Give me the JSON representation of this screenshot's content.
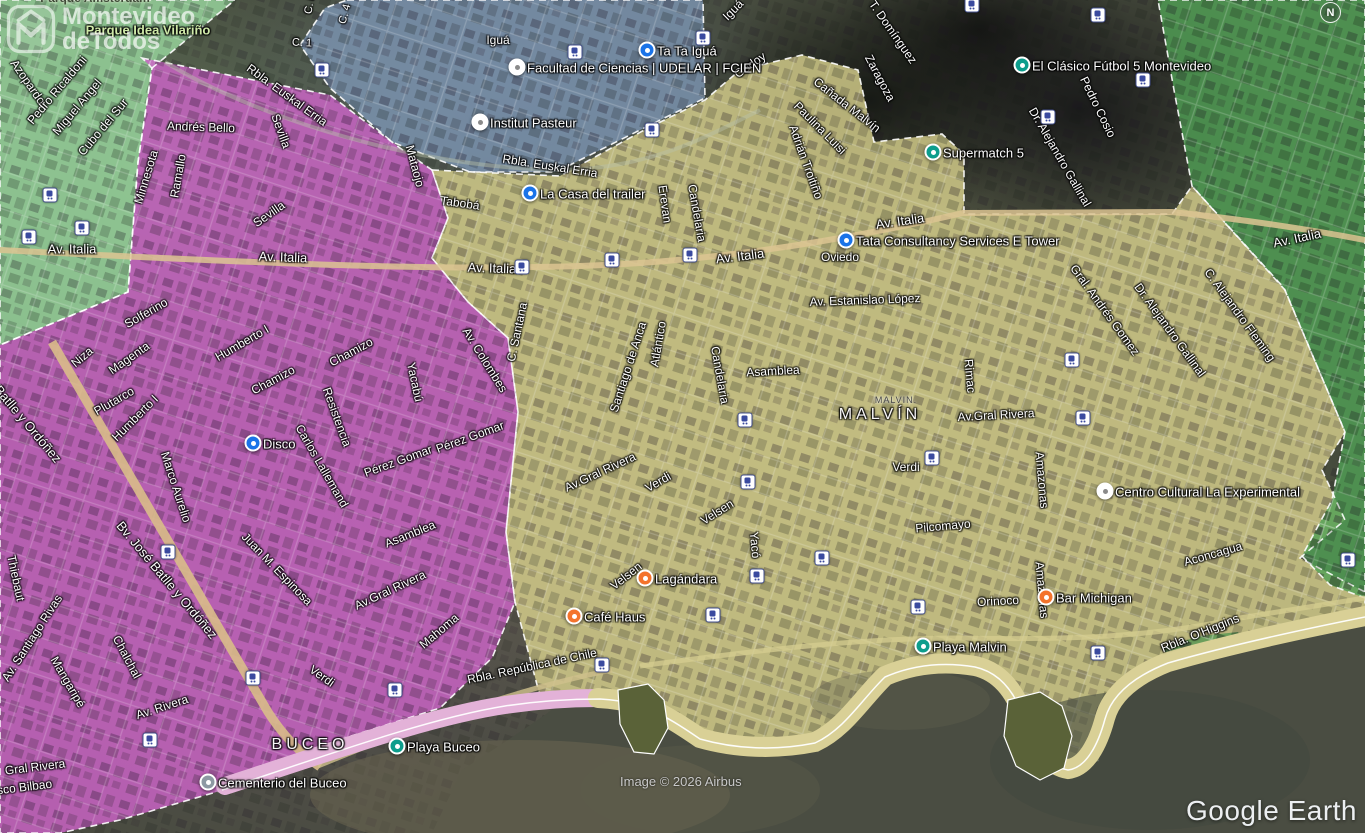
{
  "branding": {
    "logo_line1": "Montevideo",
    "logo_line2": "deTodos",
    "compass": "N",
    "attribution": "Image © 2026 Airbus",
    "google_earth": "Google Earth"
  },
  "map": {
    "zones": [
      {
        "name": "zone-green-nw",
        "fill": "rgba(150,210,155,0.85)",
        "points": "0,0 235,0 152,68 138,162 128,292 0,345",
        "dashed": true
      },
      {
        "name": "zone-blue-malvin-norte",
        "fill": "rgba(125,150,180,0.8)",
        "points": "347,0 703,0 705,98 640,130 556,172 470,172 392,142 330,88 300,45 325,8",
        "dashed": true
      },
      {
        "name": "zone-pink-buceo",
        "fill": "rgba(205,100,200,0.82)",
        "points": "142,58 330,95 400,148 432,170 448,218 432,258 468,302 508,338 518,412 506,532 515,602 492,658 440,708 345,738 230,788 120,820 60,833 0,833 0,345 128,292 138,162 152,68",
        "dashed": true
      },
      {
        "name": "zone-yellow-malvin",
        "fill": "rgba(215,207,140,0.82)",
        "points": "432,170 560,176 648,128 705,100 740,70 802,55 858,70 874,142 942,134 964,154 964,214 1172,214 1192,186 1285,290 1345,432 1322,470 1345,520 1300,558 1365,592 1365,622 1240,643 1165,663 1128,688 1110,718 1100,760 1080,770 1056,768 1036,745 1020,713 1005,688 972,667 935,663 898,668 862,690 820,742 778,748 740,744 700,738 660,712 640,700 598,698 560,702 540,696 515,602 506,532 518,412 508,338 468,302 432,258 448,218",
        "dashed": true
      },
      {
        "name": "zone-green-east",
        "fill": "rgba(80,160,85,0.8)",
        "points": "1158,0 1365,0 1365,598 1330,585 1302,556 1332,500 1345,432 1284,288 1192,186 1174,90",
        "dashed": true
      },
      {
        "name": "zone-green-headland",
        "fill": "rgba(80,150,80,0.75)",
        "points": "1162,648 1200,636 1238,632 1248,650 1220,668 1180,672",
        "dashed": false
      }
    ],
    "roads": [
      {
        "d": "M0,250 C250,263 480,274 640,263 C770,254 890,230 963,213 L1172,212 C1250,220 1312,230 1365,240",
        "color": "#dcc492",
        "w": 6,
        "o": 0.85
      },
      {
        "d": "M52,342 L268,712 C282,734 300,753 320,767",
        "color": "#d9bd8a",
        "w": 9,
        "o": 0.9
      },
      {
        "d": "M318,766 C420,724 520,688 612,670",
        "color": "#cfc08c",
        "w": 5,
        "o": 0.8
      },
      {
        "d": "M640,666 C760,650 860,638 960,638 C1060,640 1150,638 1240,618 L1365,598",
        "color": "#d5cd90",
        "w": 5,
        "o": 0.75
      },
      {
        "d": "M165,62 C260,120 420,168 560,170 C650,168 700,140 760,110",
        "color": "#b8c0a8",
        "w": 4,
        "o": 0.45
      }
    ],
    "water": {
      "fill": "#4a4d42",
      "points": "432,833 462,770 505,742 545,715 560,703 598,700 640,702 660,714 700,740 742,746 780,748 820,742 862,690 898,670 935,665 975,668 1005,690 1020,715 1040,748 1058,770 1080,772 1098,762 1110,720 1128,690 1165,665 1240,645 1365,624 1365,833",
      "tints": [
        {
          "x": 520,
          "y": 795,
          "rx": 210,
          "ry": 55,
          "fill": "#6e6751",
          "o": 0.5
        },
        {
          "x": 700,
          "y": 790,
          "rx": 120,
          "ry": 45,
          "fill": "#5d5c4b",
          "o": 0.4
        },
        {
          "x": 1150,
          "y": 760,
          "rx": 160,
          "ry": 70,
          "fill": "#434a40",
          "o": 0.6
        },
        {
          "x": 900,
          "y": 700,
          "rx": 90,
          "ry": 30,
          "fill": "#60604e",
          "o": 0.35
        }
      ]
    },
    "coast": {
      "sands": [
        {
          "d": "M225,786 C330,752 430,716 505,705 C545,699 575,698 598,698",
          "color": "#e3b2d8",
          "w": 18
        },
        {
          "d": "M598,698 C640,700 662,712 700,738 C735,748 775,750 815,742 C845,728 862,698 885,676 C915,663 945,661 975,666 C1002,672 1016,694 1024,718 C1035,748 1050,766 1068,769 C1086,767 1098,744 1105,718 C1112,693 1135,675 1168,662 C1230,644 1300,629 1365,616",
          "color": "#d9d096",
          "w": 20
        }
      ],
      "waterline": "M222,790 C330,754 430,718 505,706 C545,700 575,699 600,699 C640,701 662,713 700,739 C735,749 775,751 815,743 C845,729 862,699 885,677 C915,664 945,662 975,667 C1002,673 1016,695 1024,719 C1035,749 1050,767 1068,770 C1086,768 1098,745 1105,719 C1112,694 1135,676 1168,663 C1230,645 1300,630 1365,617",
      "headlands": [
        "618,690 648,684 664,700 668,728 654,754 634,752 620,724",
        "1008,700 1040,692 1062,706 1072,736 1064,768 1040,780 1016,766 1004,736"
      ]
    },
    "street_labels": [
      {
        "t": "Parque Idea Vilariño",
        "x": 148,
        "y": 30,
        "r": 0,
        "s": 13,
        "cls": "park"
      },
      {
        "t": "Parque Amsterdam",
        "x": 95,
        "y": -2,
        "r": 0,
        "s": 12,
        "cls": "parkdark"
      },
      {
        "t": "Azopardo",
        "x": 28,
        "y": 82,
        "r": 55
      },
      {
        "t": "Pedro Ricaldoni",
        "x": 57,
        "y": 90,
        "r": -50
      },
      {
        "t": "Miguel Angel",
        "x": 77,
        "y": 107,
        "r": -50
      },
      {
        "t": "Cubo del Sur",
        "x": 103,
        "y": 127,
        "r": -50
      },
      {
        "t": "Minnesota",
        "x": 146,
        "y": 177,
        "r": -73
      },
      {
        "t": "Ramallo",
        "x": 178,
        "y": 176,
        "r": -80
      },
      {
        "t": "Andrés Bello",
        "x": 201,
        "y": 127,
        "r": 2
      },
      {
        "t": "Sevilla",
        "x": 281,
        "y": 131,
        "r": 70
      },
      {
        "t": "Sevilla",
        "x": 269,
        "y": 214,
        "r": -35
      },
      {
        "t": "Mataojo",
        "x": 415,
        "y": 166,
        "r": 75
      },
      {
        "t": "C. 8",
        "x": 310,
        "y": 4,
        "r": -80,
        "s": 11
      },
      {
        "t": "C. 4",
        "x": 345,
        "y": 14,
        "r": -75,
        "s": 11
      },
      {
        "t": "C. 1",
        "x": 302,
        "y": 43,
        "r": 3,
        "s": 11
      },
      {
        "t": "Rbla. Euskal Erria",
        "x": 287,
        "y": 95,
        "r": 36
      },
      {
        "t": "Rbla. Euskal Erria",
        "x": 550,
        "y": 166,
        "r": 9
      },
      {
        "t": "Iguá",
        "x": 498,
        "y": 40,
        "r": 0
      },
      {
        "t": "Iguá",
        "x": 733,
        "y": 10,
        "r": -45
      },
      {
        "t": "Godoy",
        "x": 750,
        "y": 65,
        "r": -35
      },
      {
        "t": "Zaragoza",
        "x": 880,
        "y": 78,
        "r": 62
      },
      {
        "t": "T. Domínguez",
        "x": 893,
        "y": 32,
        "r": 55
      },
      {
        "t": "Pedro Cosio",
        "x": 1098,
        "y": 107,
        "r": 64
      },
      {
        "t": "Dr. Alejandro Gallinal",
        "x": 1060,
        "y": 157,
        "r": 60
      },
      {
        "t": "Cañada Malvín",
        "x": 847,
        "y": 105,
        "r": 38
      },
      {
        "t": "Paulina Luisi",
        "x": 820,
        "y": 128,
        "r": 45
      },
      {
        "t": "Adrián Troitiño",
        "x": 806,
        "y": 162,
        "r": 70
      },
      {
        "t": "Av. Italia",
        "x": 72,
        "y": 249,
        "r": 0,
        "s": 13
      },
      {
        "t": "Av. Italia",
        "x": 283,
        "y": 257,
        "r": 2,
        "s": 13
      },
      {
        "t": "Av. Italia",
        "x": 492,
        "y": 268,
        "r": 2,
        "s": 13
      },
      {
        "t": "Av. Italia",
        "x": 740,
        "y": 256,
        "r": -7,
        "s": 13
      },
      {
        "t": "Av. Italia",
        "x": 900,
        "y": 221,
        "r": -8,
        "s": 13
      },
      {
        "t": "Av. Italia",
        "x": 1297,
        "y": 238,
        "r": -12,
        "s": 13
      },
      {
        "t": "Tabobá",
        "x": 460,
        "y": 203,
        "r": 8
      },
      {
        "t": "Solferino",
        "x": 146,
        "y": 313,
        "r": -30
      },
      {
        "t": "Niza",
        "x": 82,
        "y": 357,
        "r": -40
      },
      {
        "t": "Magenta",
        "x": 129,
        "y": 358,
        "r": -35
      },
      {
        "t": "Plutarco",
        "x": 114,
        "y": 401,
        "r": -30
      },
      {
        "t": "Humberto I",
        "x": 242,
        "y": 343,
        "r": -30
      },
      {
        "t": "Humberto I",
        "x": 135,
        "y": 418,
        "r": -45
      },
      {
        "t": "Chamizo",
        "x": 273,
        "y": 380,
        "r": -28
      },
      {
        "t": "Chamizo",
        "x": 351,
        "y": 352,
        "r": -28
      },
      {
        "t": "Resistencia",
        "x": 337,
        "y": 417,
        "r": 70
      },
      {
        "t": "Yacabú",
        "x": 415,
        "y": 382,
        "r": 78
      },
      {
        "t": "Carlos Lallemand",
        "x": 322,
        "y": 466,
        "r": 60
      },
      {
        "t": "Pérez Gomar",
        "x": 398,
        "y": 461,
        "r": -20
      },
      {
        "t": "Pérez Gomar",
        "x": 470,
        "y": 437,
        "r": -20
      },
      {
        "t": "Marco Aurelio",
        "x": 176,
        "y": 487,
        "r": 72
      },
      {
        "t": "Batlle y Ordóñez",
        "x": 28,
        "y": 424,
        "r": 50,
        "s": 13
      },
      {
        "t": "Bv. José Batlle y Ordóñez",
        "x": 167,
        "y": 580,
        "r": 50,
        "s": 13
      },
      {
        "t": "Juan M. Espinosa",
        "x": 277,
        "y": 569,
        "r": 46
      },
      {
        "t": "Asamblea",
        "x": 410,
        "y": 534,
        "r": -22
      },
      {
        "t": "Av.Gral Rivera",
        "x": 390,
        "y": 590,
        "r": -25
      },
      {
        "t": "Mahoma",
        "x": 439,
        "y": 631,
        "r": -40
      },
      {
        "t": "Thiebaut",
        "x": 16,
        "y": 578,
        "r": 78
      },
      {
        "t": "Av. Santiago Rivas",
        "x": 32,
        "y": 638,
        "r": -57
      },
      {
        "t": "Mangaripé",
        "x": 68,
        "y": 682,
        "r": 60
      },
      {
        "t": "Chalchal",
        "x": 127,
        "y": 657,
        "r": 62
      },
      {
        "t": "Av. Rivera",
        "x": 162,
        "y": 707,
        "r": -18
      },
      {
        "t": "Gral Rivera",
        "x": 35,
        "y": 767,
        "r": -7
      },
      {
        "t": "Francisco Bilbao",
        "x": 8,
        "y": 789,
        "r": -7
      },
      {
        "t": "Verdi",
        "x": 322,
        "y": 676,
        "r": 35
      },
      {
        "t": "Erevan",
        "x": 665,
        "y": 204,
        "r": 82
      },
      {
        "t": "Candelaria",
        "x": 697,
        "y": 213,
        "r": 80
      },
      {
        "t": "Candelaria",
        "x": 720,
        "y": 375,
        "r": 80
      },
      {
        "t": "C. Santana",
        "x": 517,
        "y": 332,
        "r": -78
      },
      {
        "t": "Av. Colombes",
        "x": 485,
        "y": 360,
        "r": 58
      },
      {
        "t": "Santiago de Anca",
        "x": 628,
        "y": 367,
        "r": -72
      },
      {
        "t": "Atlántico",
        "x": 658,
        "y": 344,
        "r": -80
      },
      {
        "t": "Asamblea",
        "x": 773,
        "y": 371,
        "r": -3
      },
      {
        "t": "Av. Estanislao López",
        "x": 865,
        "y": 300,
        "r": -2
      },
      {
        "t": "Oviedo",
        "x": 840,
        "y": 257,
        "r": 0
      },
      {
        "t": "Rimac",
        "x": 970,
        "y": 376,
        "r": 85
      },
      {
        "t": "Gral. Andrés Gomez",
        "x": 1105,
        "y": 310,
        "r": 54
      },
      {
        "t": "Dr. Alejandro Gallinal",
        "x": 1170,
        "y": 330,
        "r": 54
      },
      {
        "t": "C. Alejandro Fleming",
        "x": 1240,
        "y": 315,
        "r": 54
      },
      {
        "t": "Av.Gral Rivera",
        "x": 996,
        "y": 415,
        "r": -3
      },
      {
        "t": "Av.Gral Rivera",
        "x": 600,
        "y": 472,
        "r": -25
      },
      {
        "t": "Verdi",
        "x": 658,
        "y": 482,
        "r": -30
      },
      {
        "t": "Verdi",
        "x": 906,
        "y": 467,
        "r": 0
      },
      {
        "t": "Velsen",
        "x": 717,
        "y": 512,
        "r": -32
      },
      {
        "t": "Velsen",
        "x": 626,
        "y": 576,
        "r": -38
      },
      {
        "t": "Yacó",
        "x": 755,
        "y": 545,
        "r": 85
      },
      {
        "t": "Pilcomayo",
        "x": 943,
        "y": 526,
        "r": -5
      },
      {
        "t": "Amazonas",
        "x": 1042,
        "y": 480,
        "r": 85
      },
      {
        "t": "Amazonas",
        "x": 1042,
        "y": 590,
        "r": 85
      },
      {
        "t": "Aconcagua",
        "x": 1213,
        "y": 554,
        "r": -16
      },
      {
        "t": "Orinoco",
        "x": 998,
        "y": 601,
        "r": -3
      },
      {
        "t": "Rbla. República de Chile",
        "x": 532,
        "y": 666,
        "r": -12
      },
      {
        "t": "Rbla. O'Higgins",
        "x": 1200,
        "y": 633,
        "r": -22
      },
      {
        "t": "MALVIN.",
        "x": 896,
        "y": 400,
        "r": 0,
        "s": 9,
        "cls": "areasmall"
      },
      {
        "t": "MALVÍN",
        "x": 880,
        "y": 415,
        "r": 0,
        "s": 16,
        "cls": "area"
      },
      {
        "t": "BUCEO",
        "x": 310,
        "y": 745,
        "r": 0,
        "s": 16,
        "cls": "area"
      }
    ],
    "poi_types": {
      "shop": {
        "bg": "#1a73e8",
        "fg": "#ffffff"
      },
      "leisure": {
        "bg": "#0c9d8c",
        "fg": "#ffffff"
      },
      "food": {
        "bg": "#f4732c",
        "fg": "#ffffff"
      },
      "civic": {
        "bg": "#ffffff",
        "fg": "#8a8a8a"
      },
      "cemetery": {
        "bg": "#8d99a3",
        "fg": "#ffffff"
      }
    },
    "pois": [
      {
        "label": "Ta Ta Iguá",
        "x": 647,
        "y": 50,
        "type": "shop"
      },
      {
        "label": "Facultad de Ciencias | UDELAR | FCIEN",
        "x": 517,
        "y": 67,
        "type": "civic"
      },
      {
        "label": "Institut Pasteur",
        "x": 480,
        "y": 122,
        "type": "civic"
      },
      {
        "label": "La Casa del trailer",
        "x": 530,
        "y": 193,
        "type": "shop"
      },
      {
        "label": "Supermatch 5",
        "x": 933,
        "y": 152,
        "type": "leisure"
      },
      {
        "label": "El Clásico Fútbol 5 Montevideo",
        "x": 1022,
        "y": 65,
        "type": "leisure"
      },
      {
        "label": "Tata Consultancy Services E Tower",
        "x": 846,
        "y": 240,
        "type": "shop"
      },
      {
        "label": "Disco",
        "x": 253,
        "y": 443,
        "type": "shop"
      },
      {
        "label": "Café Haus",
        "x": 574,
        "y": 616,
        "type": "food"
      },
      {
        "label": "Lagándara",
        "x": 645,
        "y": 578,
        "type": "food"
      },
      {
        "label": "Bar Michigan",
        "x": 1046,
        "y": 597,
        "type": "food"
      },
      {
        "label": "Playa Malvin",
        "x": 923,
        "y": 646,
        "type": "leisure"
      },
      {
        "label": "Playa Buceo",
        "x": 397,
        "y": 746,
        "type": "leisure"
      },
      {
        "label": "Cementerio del Buceo",
        "x": 208,
        "y": 782,
        "type": "cemetery"
      },
      {
        "label": "Centro Cultural La Experimental",
        "x": 1105,
        "y": 491,
        "type": "civic"
      }
    ],
    "bus_stops": [
      [
        50,
        195
      ],
      [
        82,
        228
      ],
      [
        29,
        237
      ],
      [
        322,
        70
      ],
      [
        575,
        52
      ],
      [
        703,
        38
      ],
      [
        652,
        130
      ],
      [
        522,
        267
      ],
      [
        612,
        260
      ],
      [
        690,
        255
      ],
      [
        972,
        5
      ],
      [
        1098,
        15
      ],
      [
        1143,
        80
      ],
      [
        1048,
        117
      ],
      [
        1072,
        360
      ],
      [
        745,
        420
      ],
      [
        748,
        482
      ],
      [
        757,
        576
      ],
      [
        822,
        558
      ],
      [
        932,
        458
      ],
      [
        713,
        615
      ],
      [
        602,
        665
      ],
      [
        1083,
        418
      ],
      [
        1348,
        560
      ],
      [
        918,
        607
      ],
      [
        1098,
        653
      ],
      [
        253,
        678
      ],
      [
        395,
        690
      ],
      [
        150,
        740
      ],
      [
        168,
        552
      ]
    ]
  }
}
